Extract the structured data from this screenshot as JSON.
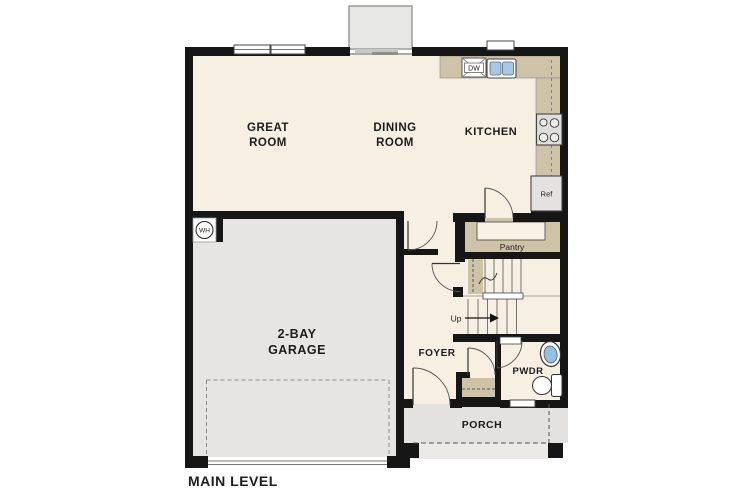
{
  "page": {
    "title": "MAIN LEVEL"
  },
  "rooms": {
    "great_room": {
      "line1": "GREAT",
      "line2": "ROOM"
    },
    "dining_room": {
      "line1": "DINING",
      "line2": "ROOM"
    },
    "kitchen": {
      "label": "KITCHEN"
    },
    "garage": {
      "line1": "2-BAY",
      "line2": "GARAGE"
    },
    "foyer": {
      "label": "FOYER"
    },
    "powder_room": {
      "label": "PWDR"
    },
    "porch": {
      "label": "PORCH"
    },
    "pantry": {
      "label": "Pantry"
    }
  },
  "fixtures": {
    "dishwasher": "DW",
    "refrigerator": "Ref",
    "water_heater": "WH",
    "stairs_up": "Up"
  },
  "colors": {
    "floor_cream": "#f6efe2",
    "garage_gray": "#e6e5e3",
    "porch_gray": "#e3e2e0",
    "porch_step_gray": "#eceae7",
    "counter_tan": "#cfc3a7",
    "wall_black": "#161616",
    "sink_blue": "#a7c9e9",
    "fixture_gray": "#e3e2e0",
    "bay_gray": "#e7e7e5"
  }
}
